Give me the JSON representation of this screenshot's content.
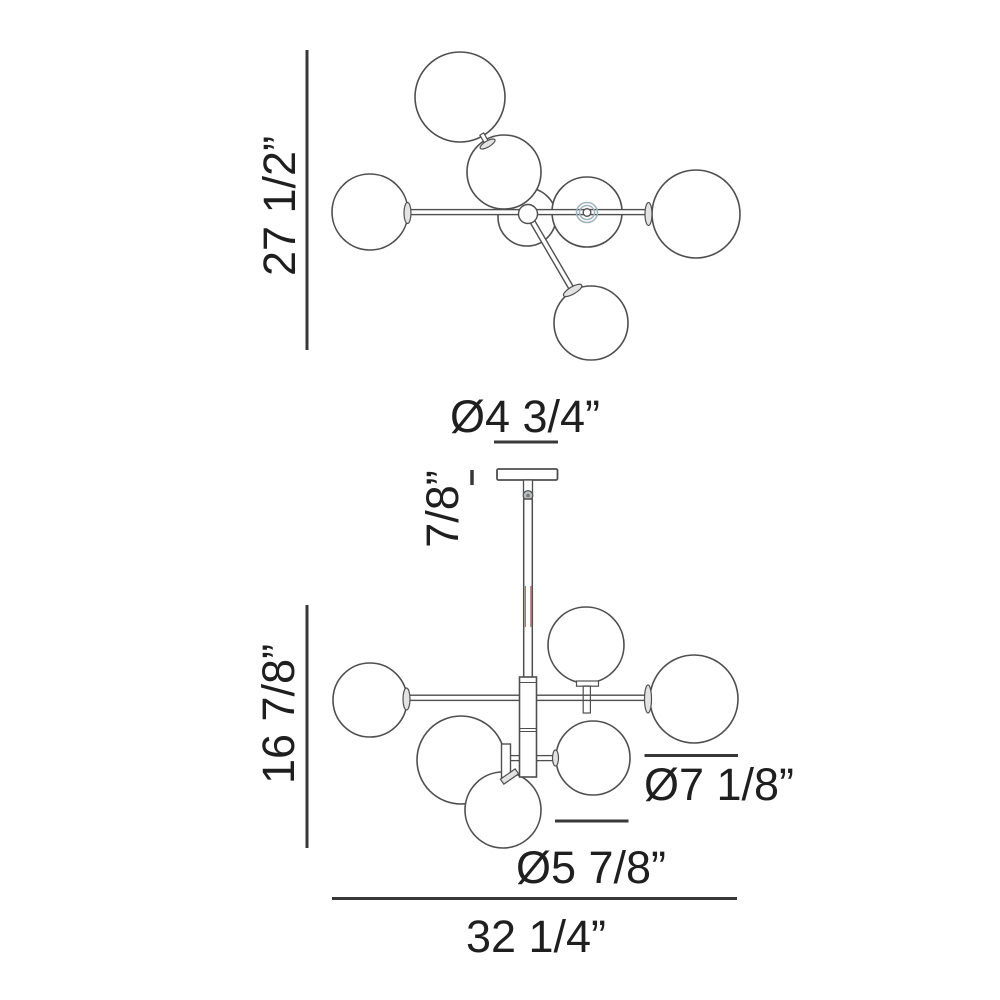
{
  "diagram": {
    "labels": {
      "plan_height": "27 1/2”",
      "canopy_diameter": "Ø4 3/4”",
      "canopy_height": "7/8”",
      "fixture_height": "16 7/8”",
      "large_globe_diameter": "Ø7 1/8”",
      "small_globe_diameter": "Ø5 7/8”",
      "overall_width": "32 1/4”"
    },
    "colors": {
      "outline": "#4f4f4f",
      "dimension": "#383838",
      "text": "#1f1f1f",
      "ring_tint": "#9fb3bb",
      "stem_accent": "#b06a60",
      "fitting_fill": "#e3e3e3"
    }
  }
}
